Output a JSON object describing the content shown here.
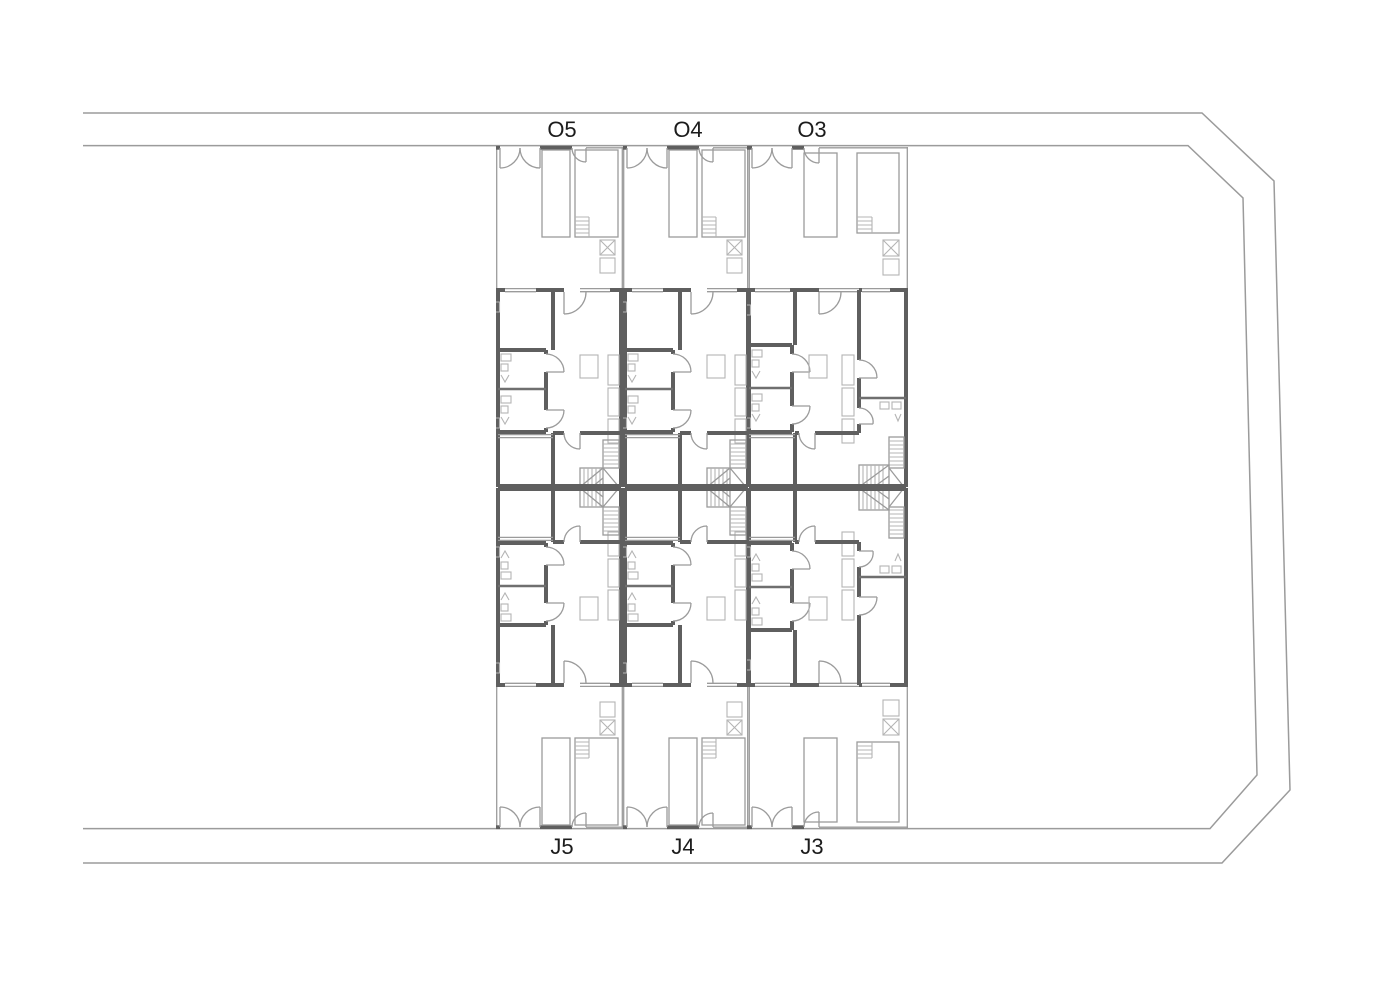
{
  "drawing": {
    "kind": "architectural-site-plan",
    "units": {
      "top_row": [
        {
          "label": "O5"
        },
        {
          "label": "O4"
        },
        {
          "label": "O3"
        }
      ],
      "bottom_row": [
        {
          "label": "J5"
        },
        {
          "label": "J4"
        },
        {
          "label": "J3"
        }
      ]
    },
    "colors": {
      "background": "#ffffff",
      "boundary_line": "#9b9b9b",
      "wall": "#5f5f5f",
      "fixture": "#b4b4b4",
      "label_text": "#1b1b1b"
    }
  }
}
